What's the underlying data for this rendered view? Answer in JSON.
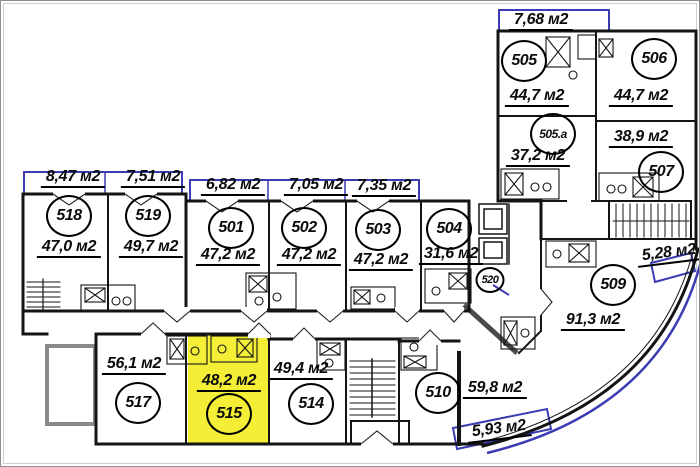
{
  "colors": {
    "highlight": "#f4ef36",
    "window_line": "#3b3bb4",
    "wall_line": "#141414"
  },
  "apartments": [
    {
      "number": "518",
      "area": "47,0 м2"
    },
    {
      "number": "519",
      "area": "49,7 м2"
    },
    {
      "number": "501",
      "area": "47,2 м2"
    },
    {
      "number": "502",
      "area": "47,2 м2"
    },
    {
      "number": "503",
      "area": "47,2 м2"
    },
    {
      "number": "504",
      "area": "31,6 м2"
    },
    {
      "number": "505",
      "area": "44,7 м2"
    },
    {
      "number": "506",
      "area": "44,7 м2"
    },
    {
      "number": "505.а",
      "area": "37,2 м2"
    },
    {
      "number": "507",
      "area": "38,9 м2"
    },
    {
      "number": "509",
      "area": "91,3 м2"
    },
    {
      "number": "510",
      "area": "59,8 м2"
    },
    {
      "number": "514",
      "area": "49,4 м2"
    },
    {
      "number": "515",
      "area": "48,2 м2",
      "highlighted": true
    },
    {
      "number": "517",
      "area": "56,1 м2"
    },
    {
      "number": "520",
      "area": ""
    }
  ],
  "balconies": [
    {
      "label": "8,47 м2"
    },
    {
      "label": "7,51 м2"
    },
    {
      "label": "6,82 м2"
    },
    {
      "label": "7,05 м2"
    },
    {
      "label": "7,35 м2"
    },
    {
      "label": "7,68 м2"
    },
    {
      "label": "5,28 м2"
    },
    {
      "label": "5,93 м2"
    }
  ]
}
